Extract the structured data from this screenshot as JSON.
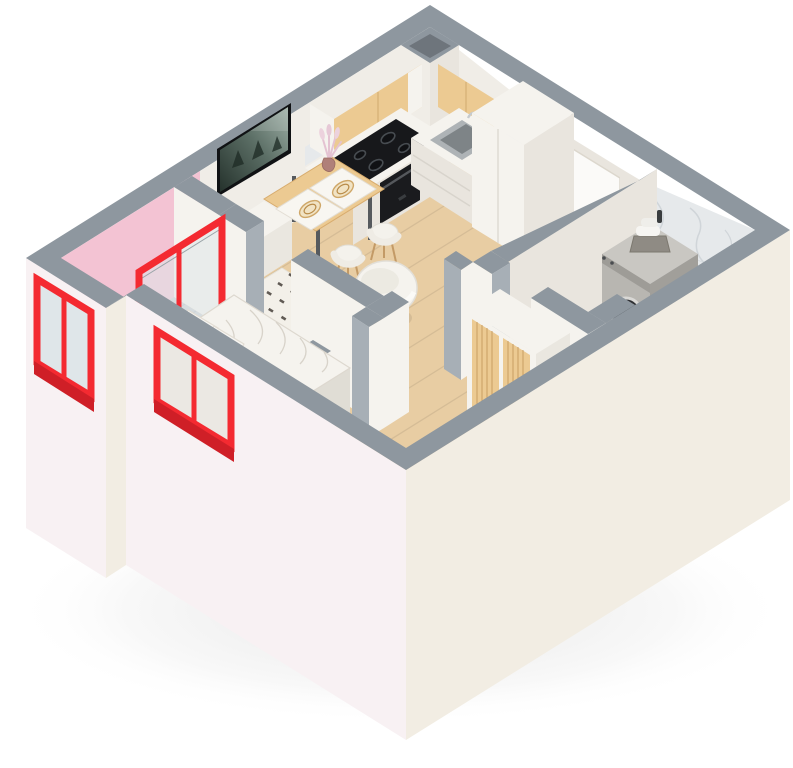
{
  "scene": {
    "kind": "isometric-3d-apartment-floor-plan-render",
    "background": "white",
    "rooms": [
      "living-room-with-kitchen",
      "balcony",
      "bedroom",
      "hallway",
      "bathroom"
    ],
    "red_framed_openings": 3,
    "stove_burners": 4,
    "dining_chairs": 2,
    "placemats": 2,
    "bed_pillows": 2
  },
  "objects": {
    "living_kitchen": [
      "wall-tv",
      "tv-sideboard",
      "dining-table",
      "dining-chairs",
      "placemats-with-plates",
      "vase-dried-flowers",
      "upper-cabinets-wood",
      "corner-vent-duct",
      "marble-backsplash",
      "cooktop-black",
      "oven-black",
      "kitchen-sink",
      "tall-cabinets",
      "patterned-rug",
      "round-armchair"
    ],
    "balcony": [
      "pink-wall",
      "tiled-floor",
      "palm-plant",
      "red-window",
      "red-glass-door"
    ],
    "bedroom": [
      "double-bed-white-bedding",
      "pillows",
      "red-window"
    ],
    "hallway": [
      "entrance-door",
      "slatted-wardrobe"
    ],
    "bathroom": [
      "washing-machine",
      "towel-basket",
      "toilet",
      "bathtub",
      "marble-walls",
      "corner-duct"
    ]
  },
  "colors": {
    "wall_cap": "#8e979f",
    "wall_cap_light": "#a7afb6",
    "wall_white": "#f0ede7",
    "wall_white_shade": "#e9e5de",
    "wall_pink": "#f3c3d3",
    "ext_front_left": "#f8f1f3",
    "ext_front_right": "#f2ede3",
    "accent_red": "#f42a31",
    "accent_red_dark": "#cf1f27",
    "wood_floor": "#e8cda3",
    "cabinet_wood": "#ecca92",
    "cabinet_wood_dark": "#dfb87e",
    "furniture_white": "#f5f3ee",
    "furniture_shade": "#eae7e0",
    "furniture_dark": "#e0ddd5",
    "marble_wall": "#e6e9eb",
    "marble_floor": "#eceef0",
    "tile": "#ccd0d3",
    "tile_line": "#b8bdc0",
    "appliance_black": "#17181b",
    "glass": "#dfe6e9",
    "silver": "#b8b6b1",
    "silver_dark": "#a19f9a",
    "silver_light": "#c9c7c2",
    "textile": "#f5f3ee",
    "rug": "#f3f0e9",
    "rug_dash": "#46403a",
    "rug_pink": "#f3abc0",
    "tv_frame": "#101214",
    "green_dark": "#3f6b2f",
    "green_mid": "#4e7b3a",
    "green_light": "#6f9d4f",
    "gold": "#cfa768"
  }
}
